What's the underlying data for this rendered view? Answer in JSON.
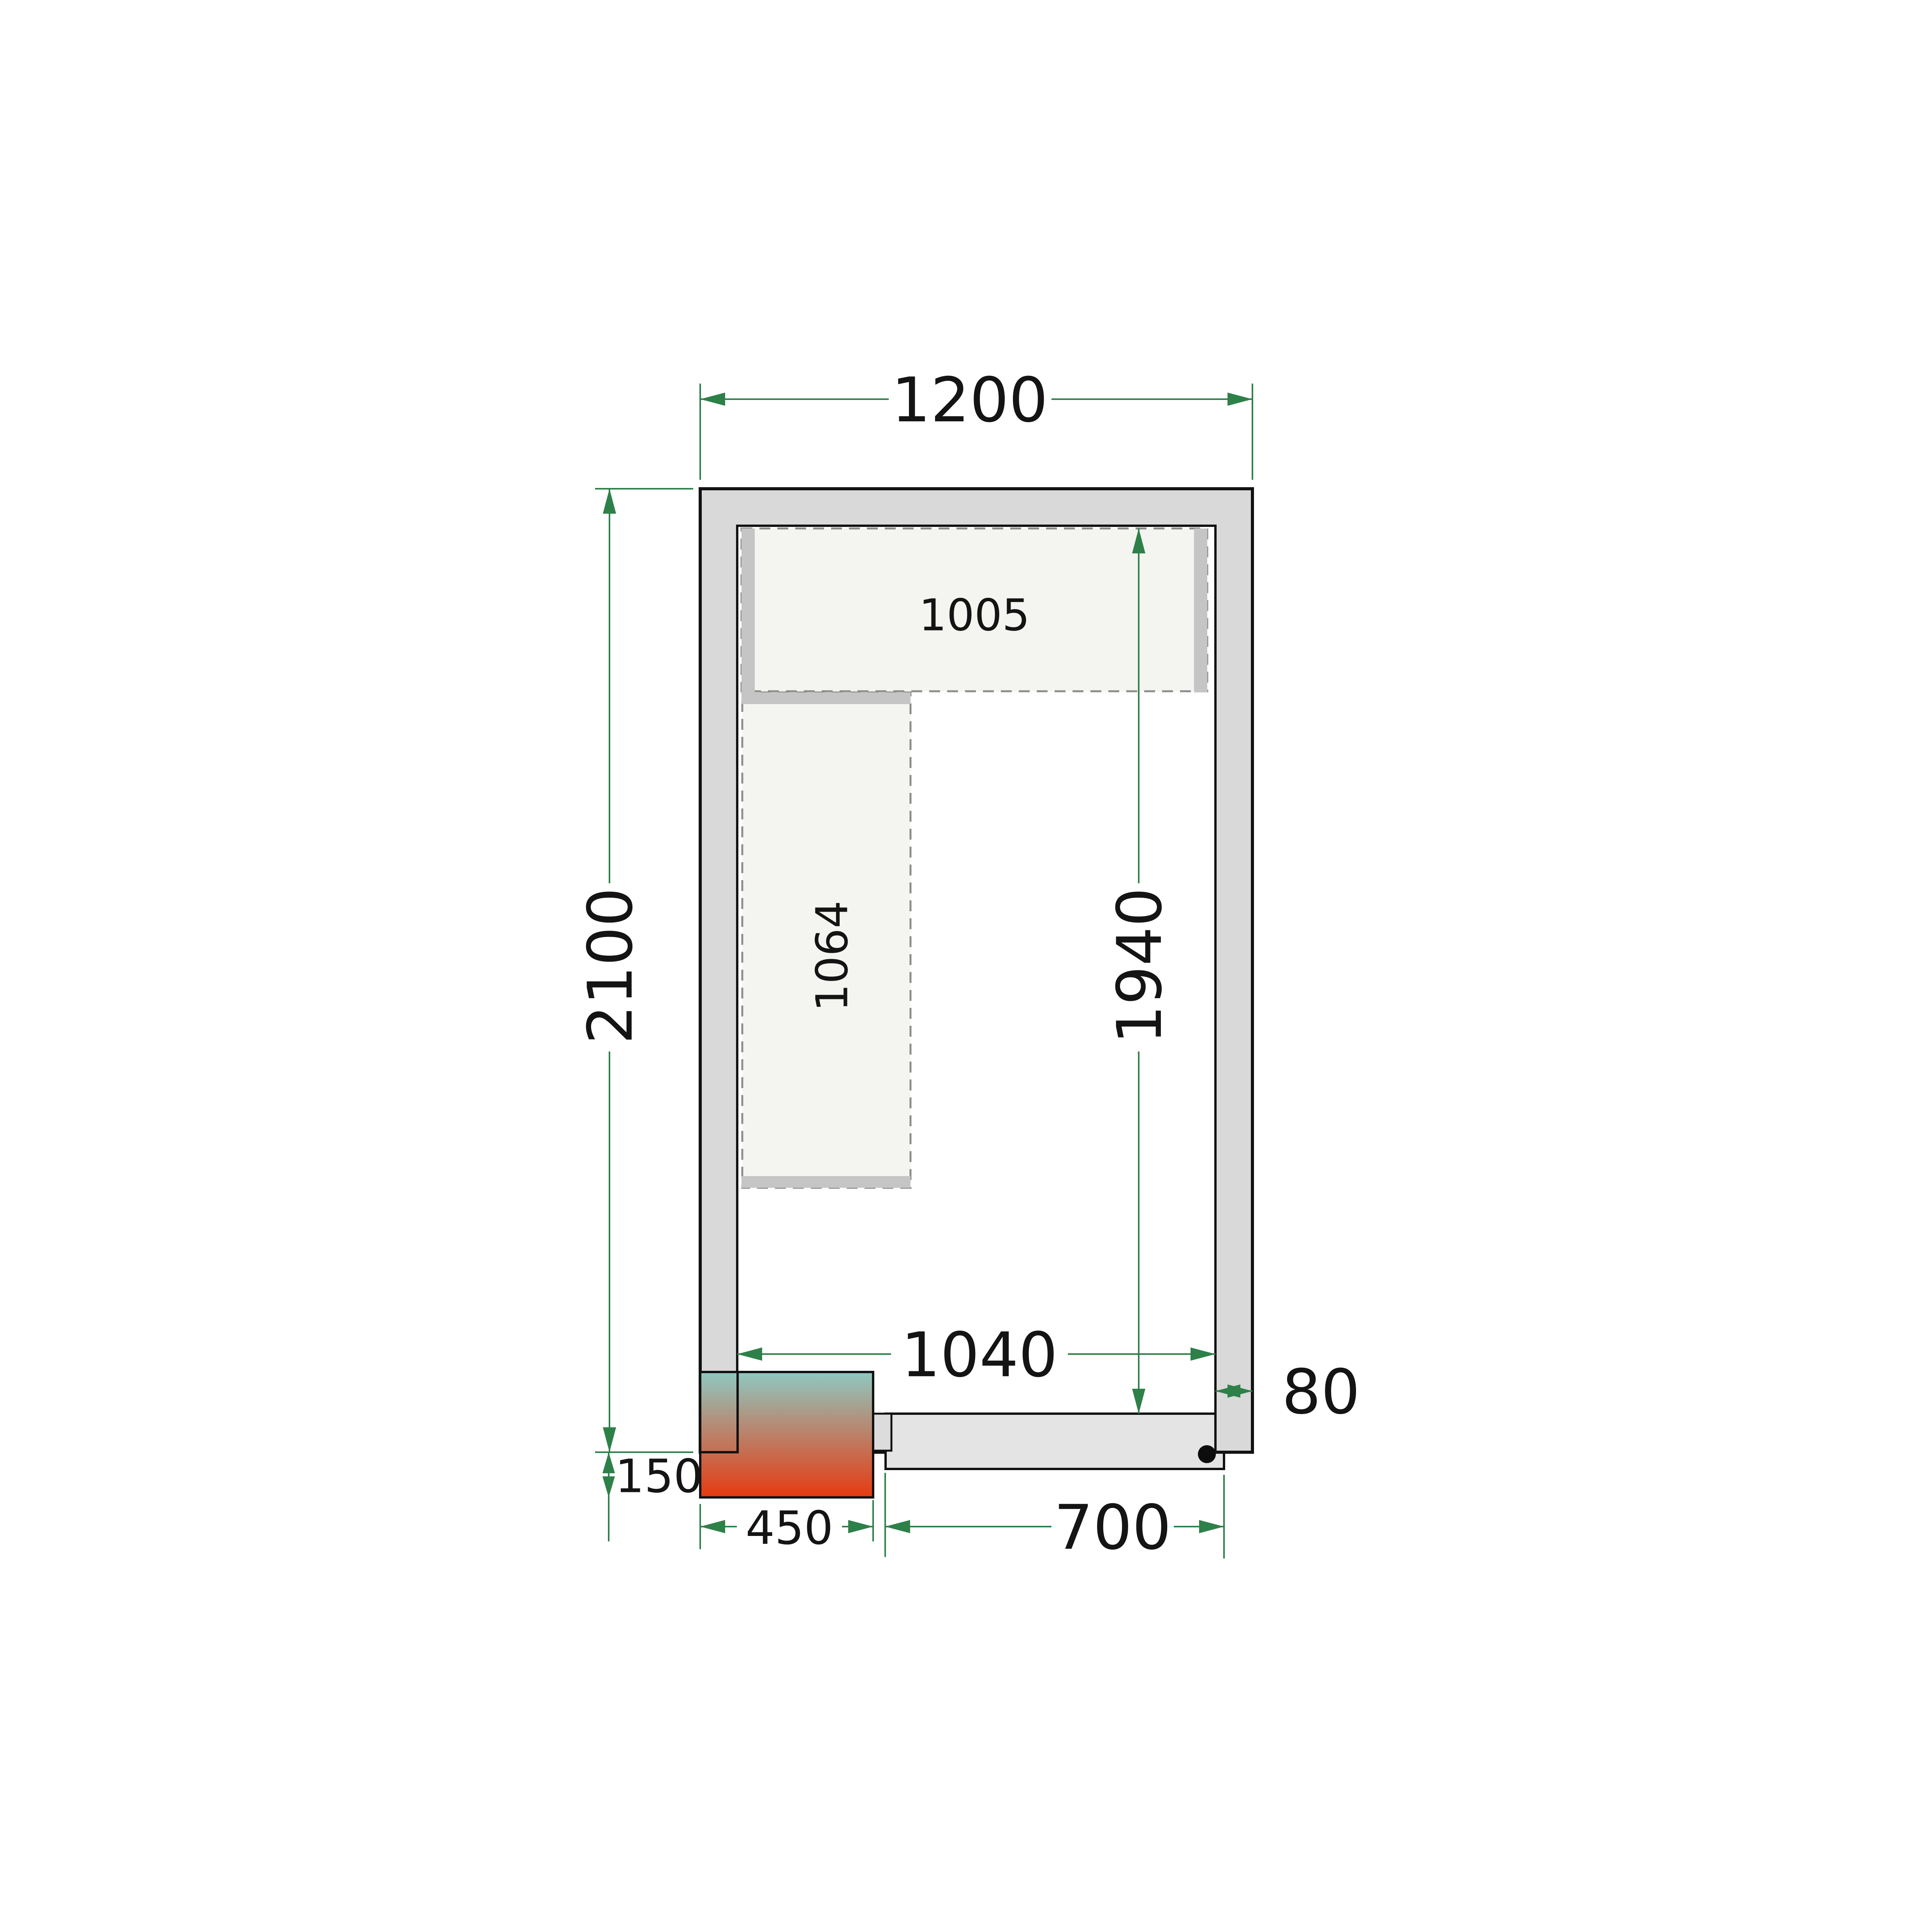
{
  "drawing": {
    "type_note": "cold room floor plan",
    "labels": {
      "overall_width": "1200",
      "overall_depth": "2100",
      "interior_width": "1040",
      "interior_depth": "1940",
      "wall_thickness": "80",
      "top_shelf_length": "1005",
      "left_shelf_length": "1064",
      "cooling_unit_width": "450",
      "cooling_unit_protrusion": "150",
      "door_width": "700"
    },
    "colors": {
      "dimension_green": "#2e8049",
      "wall_fill": "#d9d9d9",
      "outline_black": "#121212",
      "shelf_fill": "#f4f4f1",
      "shelf_border_gray": "#8c8c8c",
      "shelf_rail_gray": "#c5c5c5",
      "door_leaf_fill": "#e4e4e4",
      "door_stub_fill": "#dcdcdc",
      "unit_gradient_top": "#8fc8c1",
      "unit_gradient_bottom": "#e63a10",
      "hinge_dot": "#0d0d0d"
    }
  }
}
